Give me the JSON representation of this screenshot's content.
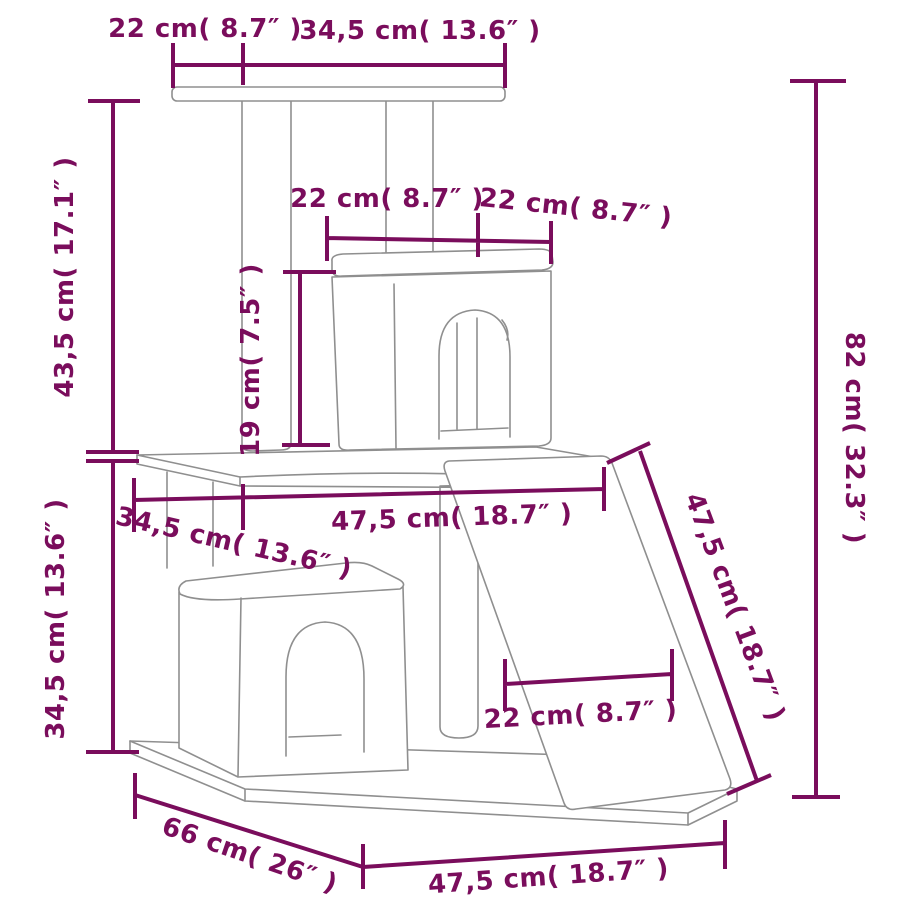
{
  "diagram": {
    "subject": "cat tree scratching-post tower dimension drawing",
    "colors": {
      "dimension_annotations": "#7a0d5c",
      "product_outline": "#8f8f8f",
      "background": "#ffffff"
    },
    "dimensions": {
      "top_platform_depth": {
        "text": "22 cm( 8.7″ )",
        "cm": 22,
        "inch": 8.7
      },
      "top_platform_width": {
        "text": "34,5 cm( 13.6″ )",
        "cm": 34.5,
        "inch": 13.6
      },
      "upper_section_height": {
        "text": "43,5 cm( 17.1″ )",
        "cm": 43.5,
        "inch": 17.1
      },
      "condo_width_left": {
        "text": "22 cm( 8.7″ )",
        "cm": 22,
        "inch": 8.7
      },
      "condo_width_right": {
        "text": "22 cm( 8.7″ )",
        "cm": 22,
        "inch": 8.7
      },
      "post_height": {
        "text": "19 cm( 7.5″ )",
        "cm": 19,
        "inch": 7.5
      },
      "total_height": {
        "text": "82 cm( 32.3″ )",
        "cm": 82,
        "inch": 32.3
      },
      "mid_platform_depth": {
        "text": "34,5 cm( 13.6″ )",
        "cm": 34.5,
        "inch": 13.6
      },
      "mid_platform_width": {
        "text": "47,5 cm( 18.7″ )",
        "cm": 47.5,
        "inch": 18.7
      },
      "ramp_length": {
        "text": "47,5 cm( 18.7″ )",
        "cm": 47.5,
        "inch": 18.7
      },
      "lower_section_height": {
        "text": "34,5 cm( 13.6″ )",
        "cm": 34.5,
        "inch": 13.6
      },
      "ramp_width": {
        "text": "22 cm( 8.7″ )",
        "cm": 22,
        "inch": 8.7
      },
      "base_depth": {
        "text": "66 cm( 26″ )",
        "cm": 66,
        "inch": 26
      },
      "base_width": {
        "text": "47,5 cm( 18.7″ )",
        "cm": 47.5,
        "inch": 18.7
      }
    }
  }
}
